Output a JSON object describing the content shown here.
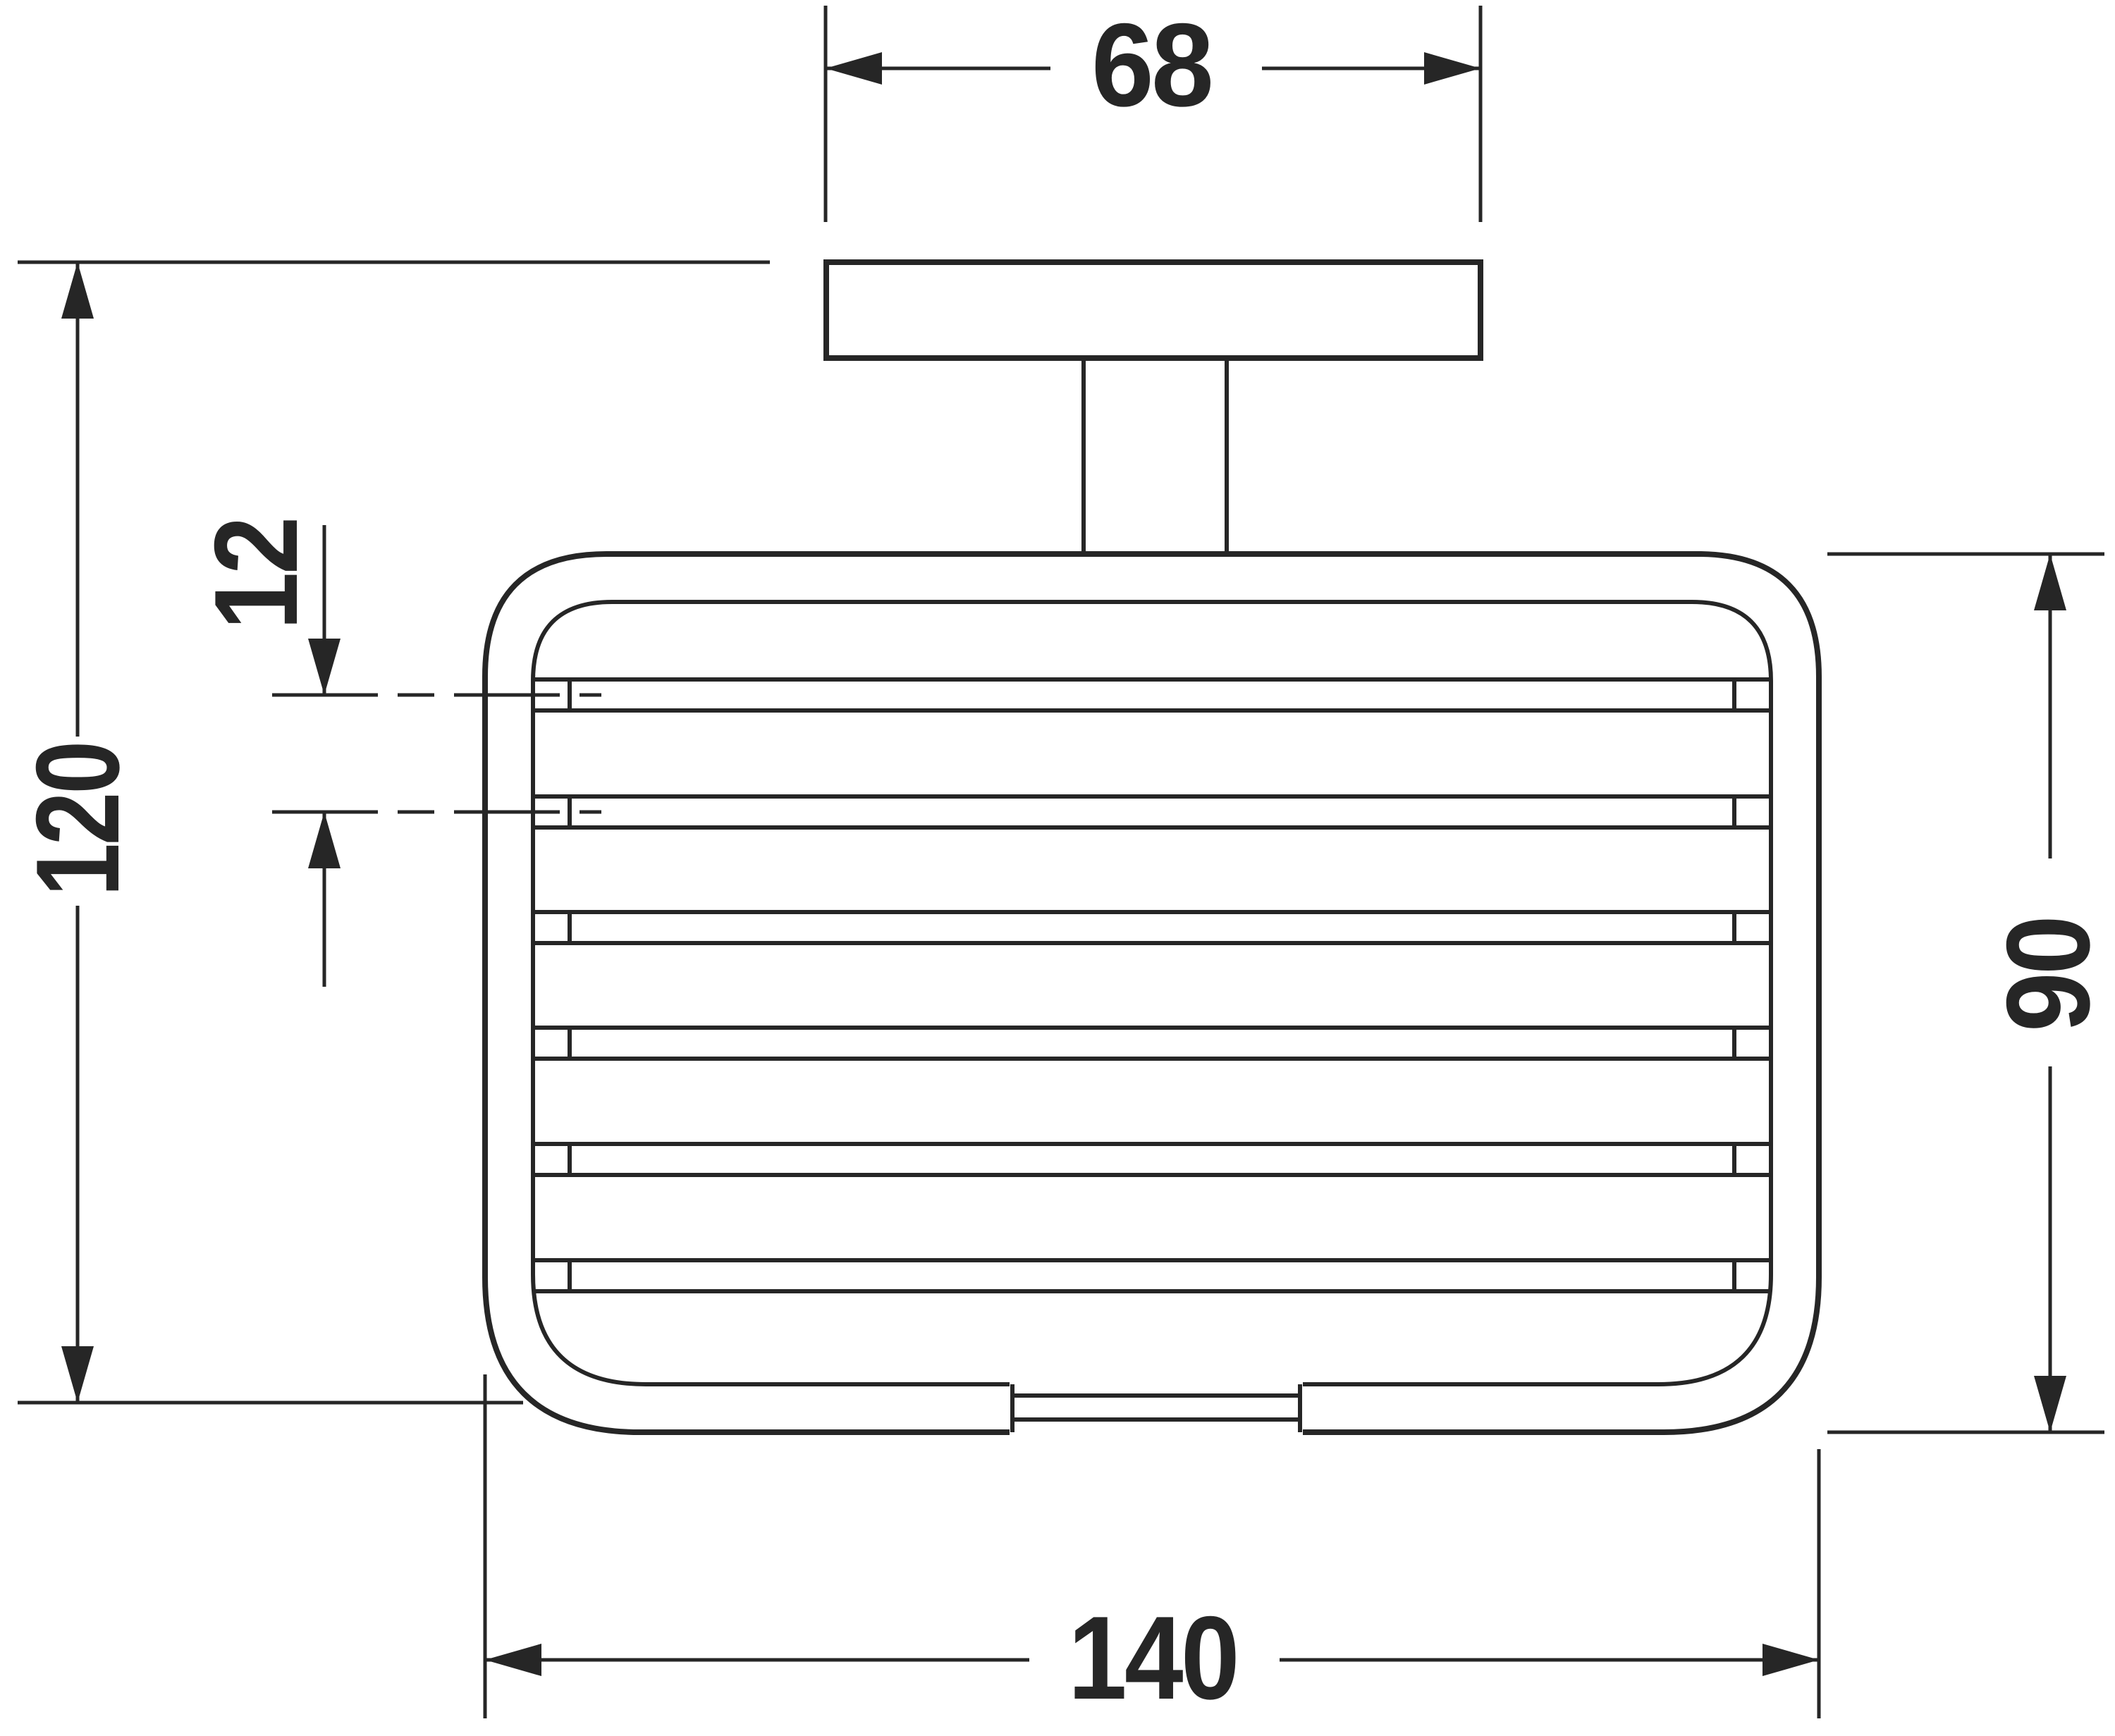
{
  "drawing": {
    "background_color": "#ffffff",
    "line_color": "#262626",
    "dimensions": {
      "mount_plate_width": {
        "label": "68"
      },
      "overall_height": {
        "label": "120"
      },
      "wire_spacing": {
        "label": "12"
      },
      "basket_height": {
        "label": "90"
      },
      "basket_width": {
        "label": "140"
      }
    }
  }
}
